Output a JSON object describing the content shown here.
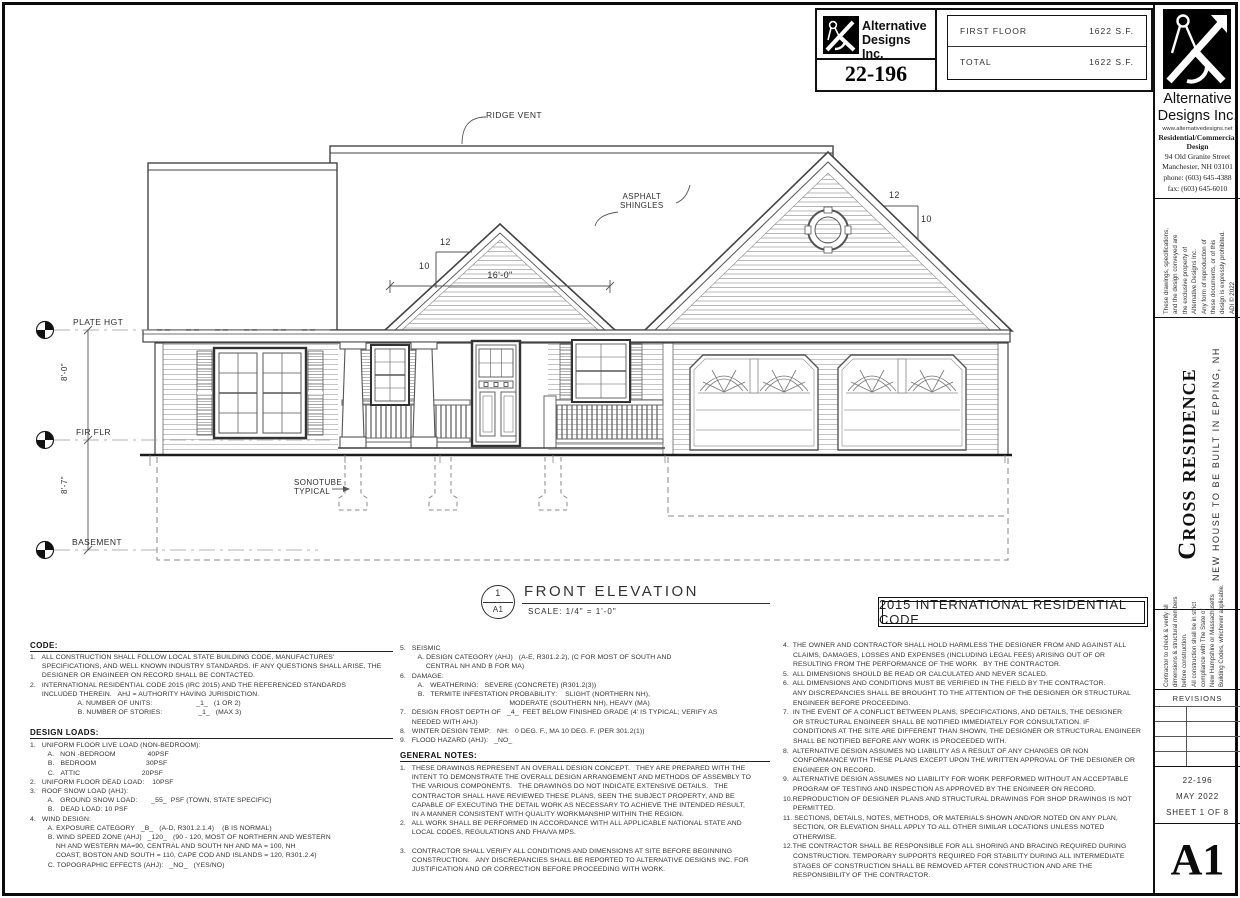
{
  "title_block": {
    "company_name_1": "Alternative",
    "company_name_2": "Designs Inc.",
    "project_number": "22-196",
    "rows": [
      {
        "label": "FIRST FLOOR",
        "value": "1622 S.F."
      },
      {
        "label": "TOTAL",
        "value": "1622 S.F."
      }
    ]
  },
  "drawing": {
    "labels": {
      "ridge_vent": "RIDGE VENT",
      "asphalt_shingles": [
        "ASPHALT",
        "SHINGLES"
      ],
      "plate_height": "PLATE HGT",
      "first_floor": "FIR FLR",
      "basement": "BASEMENT",
      "sonotube": [
        "SONOTUBE",
        "TYPICAL"
      ],
      "dim_gable_width": "16'-0\"",
      "dim_first_to_plate": "8'-0\"",
      "dim_basement_to_first": "8'-7\"",
      "pitch_rise": "12",
      "pitch_run": "10"
    },
    "title": "FRONT ELEVATION",
    "scale_label": "SCALE:  1/4\" = 1'-0\"",
    "detail_number": "1",
    "detail_sheet": "A1",
    "code_banner": "2015 INTERNATIONAL RESIDENTIAL CODE"
  },
  "notes": {
    "col1": {
      "code_heading": "CODE:",
      "code_lines": [
        "1.   ALL CONSTRUCTION SHALL FOLLOW LOCAL STATE BUILDING CODE, MANUFACTURES'",
        "      SPECIFICATIONS, AND WELL KNOWN INDUSTRY STANDARDS. IF ANY QUESTIONS SHALL ARISE, THE",
        "      DESIGNER OR ENGINEER ON RECORD SHALL BE CONTACTED.",
        "2.   INTERNATIONAL RESIDENTIAL CODE 2015 (IRC 2015) AND THE REFERENCED STANDARDS",
        "      INCLUDED THEREIN.   AHJ = AUTHORITY HAVING JURISDICTION.",
        "                        A. NUMBER OF UNITS:                      _1_   (1 OR 2)",
        "                        B. NUMBER OF STORIES:                  _1_   (MAX 3)"
      ],
      "loads_heading": "DESIGN LOADS:",
      "loads_lines": [
        "1.   UNIFORM FLOOR LIVE LOAD (NON-BEDROOM):",
        "         A.   NON -BEDROOM                40PSF",
        "         B.   BEDROOM                         30PSF",
        "         C.   ATTIC                               20PSF",
        "2.   UNIFORM FLOOR DEAD LOAD:    10PSF",
        "3.   ROOF SNOW LOAD (AHJ):",
        "         A.   GROUND SNOW LOAD:       _55_  PSF (TOWN, STATE SPECIFIC)",
        "         B.   DEAD LOAD: 10 PSF",
        "4.   WIND DESIGN:",
        "         A. EXPOSURE CATEGORY   _B_   (A-D, R301.2.1.4)    (B IS NORMAL)",
        "         B. WIND SPEED ZONE (AHJ)   _120_   (90 - 120, MOST OF NORTHERN AND WESTERN",
        "             NH AND WESTERN MA=90, CENTRAL AND SOUTH NH AND MA = 100, NH",
        "             COAST, BOSTON AND SOUTH = 110, CAPE COD AND ISLANDS = 120, R301.2.4)",
        "         C. TOPOGRAPHIC EFFECTS (AHJ):   _NO_   (YES/NO)"
      ]
    },
    "col2": {
      "items_5_9": [
        "5.   SEISMIC",
        "         A. DESIGN CATEGORY (AHJ)   (A-E, R301.2.2), (C FOR MOST OF SOUTH AND",
        "             CENTRAL NH AND B FOR MA)",
        "6.   DAMAGE:",
        "         A.   WEATHERING:   SEVERE (CONCRETE) (R301.2(3))",
        "         B.   TERMITE INFESTATION PROBABILITY:    SLIGHT (NORTHERN NH),",
        "                                                       MODERATE (SOUTHERN NH), HEAVY (MA)",
        "7.   DESIGN FROST DEPTH OF   _4_  FEET BELOW FINISHED GRADE (4' IS TYPICAL; VERIFY AS",
        "      NEEDED WITH AHJ)",
        "8.   WINTER DESIGN TEMP:   NH:   0 DEG. F., MA 10 DEG. F. (PER 301.2(1))",
        "9.   FLOOD HAZARD (AHJ):   _NO_"
      ],
      "general_heading": "GENERAL NOTES:",
      "items_1_3": [
        "1.   THESE DRAWINGS REPRESENT AN OVERALL DESIGN CONCEPT.   THEY ARE PREPARED WITH THE",
        "      INTENT TO DEMONSTRATE THE OVERALL DESIGN ARRANGEMENT AND METHODS OF ASSEMBLY TO",
        "      THE VARIOUS COMPONENTS.   THE DRAWINGS DO NOT INDICATE EXTENSIVE DETAILS.   THE",
        "      CONTRACTOR SHALL HAVE REVIEWED THESE PLANS, SEEN THE SUBJECT PROPERTY, AND BE",
        "      CAPABLE OF EXECUTING THE DETAIL WORK AS NECESSARY TO ACHIEVE THE INTENDED RESULT,",
        "      IN A MANNER CONSISTENT WITH QUALITY WORKMANSHIP WITHIN THE REGION.",
        "2.   ALL WORK SHALL BE PERFORMED IN ACCORDANCE WITH ALL APPLICABLE NATIONAL STATE AND",
        "      LOCAL CODES, REGULATIONS AND FHA/VA MPS.",
        "",
        "3.   CONTRACTOR SHALL VERIFY ALL CONDITIONS AND DIMENSIONS AT SITE BEFORE BEGINNING",
        "      CONSTRUCTION.   ANY DISCREPANCIES SHALL BE REPORTED TO ALTERNATIVE DESIGNS INC. FOR",
        "      JUSTIFICATION AND OR CORRECTION BEFORE PROCEEDING WITH WORK."
      ]
    },
    "col3": {
      "items_4_12": [
        "4.  THE OWNER AND CONTRACTOR SHALL HOLD HARMLESS THE DESIGNER FROM AND AGAINST ALL",
        "     CLAIMS, DAMAGES, LOSSES AND EXPENSES (INCLUDING LEGAL FEES) ARISING OUT OF OR",
        "     RESULTING FROM THE PERFORMANCE OF THE WORK   BY THE CONTRACTOR.",
        "5.  ALL DIMENSIONS SHOULD BE READ OR CALCULATED AND NEVER SCALED.",
        "6.  ALL DIMENSIONS AND CONDITIONS MUST BE VERIFIED IN THE FIELD BY THE CONTRACTOR.",
        "     ANY DISCREPANCIES SHALL BE BROUGHT TO THE ATTENTION OF THE DESIGNER OR STRUCTURAL",
        "     ENGINEER BEFORE PROCEEDING.",
        "7.  IN THE EVENT OF A CONFLICT BETWEEN PLANS, SPECIFICATIONS, AND DETAILS, THE DESIGNER",
        "     OR STRUCTURAL ENGINEER SHALL BE NOTIFIED IMMEDIATELY FOR CONSULTATION. IF",
        "     CONDITIONS AT THE SITE ARE DIFFERENT THAN SHOWN, THE DESIGNER OR STRUCTURAL ENGINEER",
        "     SHALL BE NOTIFIED BEFORE ANY WORK IS PROCEEDED WITH.",
        "8.  ALTERNATIVE DESIGN ASSUMES NO LIABILITY AS A RESULT OF ANY CHANGES OR NON",
        "     CONFORMANCE WITH THESE PLANS EXCEPT UPON THE WRITTEN APPROVAL OF THE DESIGNER OR",
        "     ENGINEER ON RECORD.",
        "9.  ALTERNATIVE DESIGN ASSUMES NO LIABILITY FOR WORK PERFORMED WITHOUT AN ACCEPTABLE",
        "     PROGRAM OF TESTING AND INSPECTION AS APPROVED BY THE ENGINEER ON RECORD.",
        "10.REPRODUCTION OF DESIGNER PLANS AND STRUCTURAL DRAWINGS FOR SHOP DRAWINGS IS NOT",
        "     PERMITTED.",
        "11. SECTIONS, DETAILS, NOTES, METHODS, OR MATERIALS SHOWN AND/OR NOTED ON ANY PLAN,",
        "     SECTION, OR ELEVATION SHALL APPLY TO ALL OTHER SIMILAR LOCATIONS UNLESS NOTED",
        "     OTHERWISE.",
        "12.THE CONTRACTOR SHALL BE RESPONSIBLE FOR ALL SHORING AND BRACING REQUIRED DURING",
        "     CONSTRUCTION. TEMPORARY SUPPORTS REQUIRED FOR STABILITY DURING ALL INTERMEDIATE",
        "     STAGES OF CONSTRUCTION SHALL BE REMOVED AFTER CONSTRUCTION AND ARE THE",
        "     RESPONSIBILITY OF THE CONTRACTOR."
      ]
    }
  },
  "sidebar": {
    "company_name_1": "Alternative",
    "company_name_2": "Designs Inc.",
    "website": "www.alternativedesigns.net",
    "tagline": [
      "Residential/Commercial",
      "Design"
    ],
    "address": [
      "94 Old Granite Street",
      "Manchester, NH 03101"
    ],
    "phone": "phone:  (603) 645-4388",
    "fax": "fax:  (603) 645-6010",
    "copyright_lines": [
      "These drawings, specifications,",
      "and the design conveyed are",
      "the exclusive property of",
      "Alternative Designs Inc.",
      "Any form of reproduction of",
      "these documents, or of this",
      "design is expressly prohibited.",
      "ADI © 2022"
    ],
    "project_title": "Cross residence",
    "project_subtitle": "NEW HOUSE TO BE BUILT IN EPPING, NH",
    "contractor_note_lines": [
      "Contractor to check & verify all",
      "dimensions & structural members",
      "before construction.",
      "All construction shall be in strict",
      "compliance with The State of",
      "New Hampshire or Massachusetts",
      "Building Codes, whichever applicable."
    ],
    "revisions_label": "REVISIONS",
    "project_number": "22-196",
    "date": "MAY 2022",
    "sheet": "SHEET 1 OF 8",
    "sheet_id": "A1"
  }
}
